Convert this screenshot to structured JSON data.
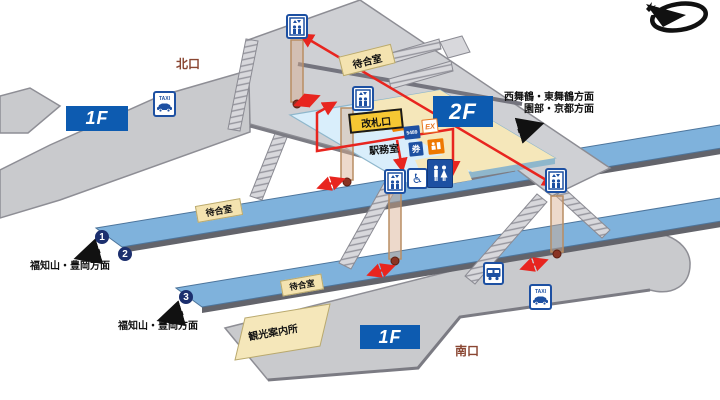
{
  "exits": {
    "north": "北口",
    "south": "南口"
  },
  "floors": {
    "north_1f": "1F",
    "concourse_2f": "2F",
    "south_1f": "1F"
  },
  "labels": {
    "ticket_gate": "改札口",
    "station_office": "駅務室",
    "tourist_information": "観光案内所",
    "waiting_rooms": [
      "待合室",
      "待合室",
      "待合室"
    ]
  },
  "directions": {
    "east_line1": "西舞鶴・東舞鶴方面",
    "east_line2": "園部・京都方面",
    "west_upper": "福知山・豊岡方面",
    "west_lower": "福知山・豊岡方面"
  },
  "platform_numbers": {
    "p1": "1",
    "p2": "2",
    "p3": "3"
  },
  "machines": {
    "m5489": "5489",
    "ex": "EX",
    "ticket": "券"
  },
  "icons": {
    "taxi_label": "TAXI",
    "wheelchair_glyph": "♿"
  },
  "colors": {
    "route_red": "#e8251f",
    "floor_box_blue": "#0d5bb0",
    "platform_blue": "#7fb2dc",
    "concourse_cyan": "#d9eefb",
    "ground_gray": "#c9cacd",
    "accent_yellow": "#f6c733",
    "machine_orange": "#ee7800",
    "machine_blue": "#1d50a2",
    "exit_text_brown": "#8a4632"
  }
}
